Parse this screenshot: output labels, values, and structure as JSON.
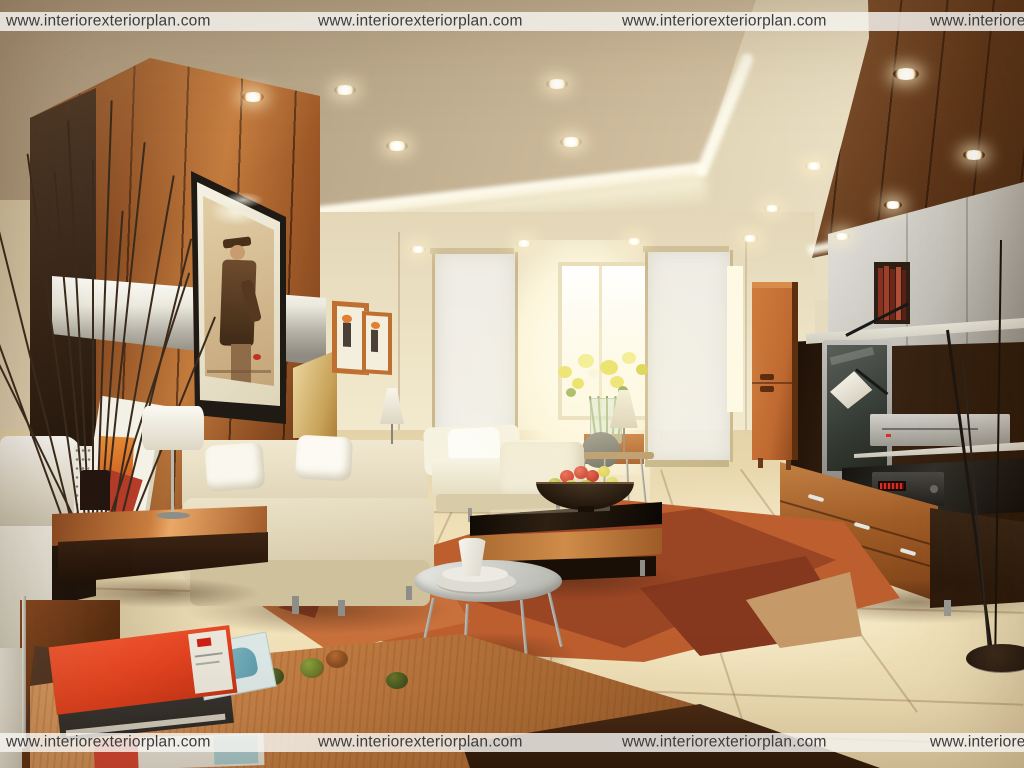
{
  "title": "Living room interior render",
  "watermark": {
    "text": "www.interiorexteriorplan.com",
    "band_background": "rgba(246,245,241,0.82)",
    "text_color": "#3c3c3c",
    "top_band_repetitions": 4,
    "bottom_band_repetitions": 4
  },
  "palette": {
    "wmBand": "rgba(246,245,241,0.82)",
    "wmText": "#3c3c3c",
    "ceilingTan": "#bcaa8c",
    "ceilingCream": "#e7ddc2",
    "coveWhite": "#fffdf0",
    "wallCream": "#e9dfc3",
    "woodCopper": "#b06a32",
    "woodDark": "#4a2a14",
    "rugOrange": "#bd5e2f",
    "rugRust": "#9a4524",
    "rugMaroon": "#86381e",
    "rugTan": "#c69a68",
    "floorCream": "#f2e4bc",
    "sofaCream": "#ece3ca",
    "bookRed": "#e0421f",
    "cabinetOrange": "#c06a32",
    "ledRed": "#d92f22",
    "fruitRed": "#c93527",
    "fruitGreen": "#a8b23c",
    "flowerYellow": "#e9e05c"
  },
  "scene": {
    "description": "3D render of a modern living room: copper wood-paneled wall with framed art, white sofas, orange geometric rug, TV wall unit, recessed ceiling lights and a bright daylight window."
  }
}
